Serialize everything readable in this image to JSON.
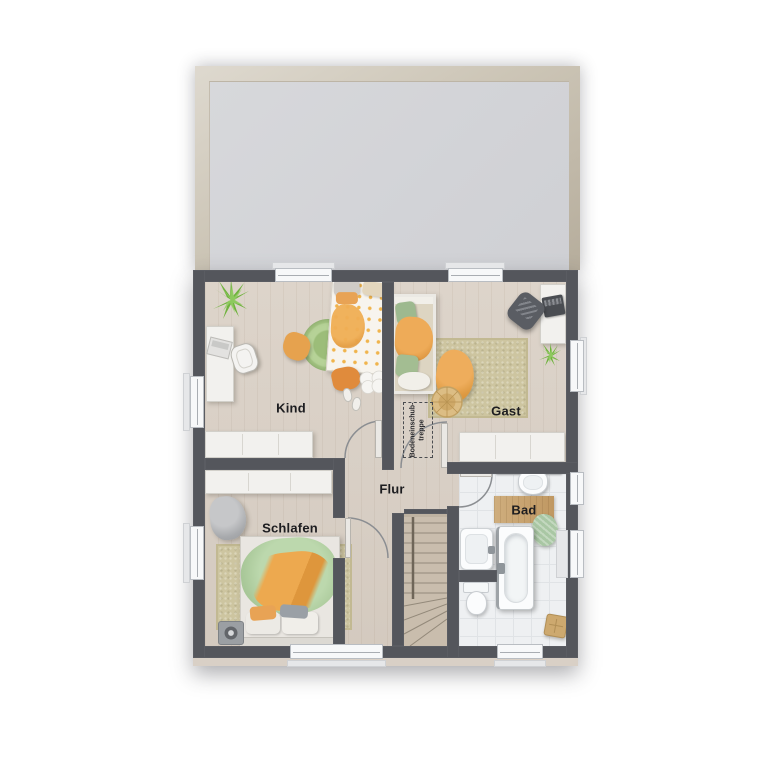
{
  "floorplan": {
    "rooms": [
      {
        "id": "kind",
        "label": "Kind"
      },
      {
        "id": "gast",
        "label": "Gast"
      },
      {
        "id": "flur",
        "label": "Flur"
      },
      {
        "id": "schlafen",
        "label": "Schlafen"
      },
      {
        "id": "bad",
        "label": "Bad"
      }
    ],
    "annotations": {
      "attic_stairs": {
        "line1": "Bodeneinschub-",
        "line2": "treppe"
      }
    },
    "colors": {
      "wall": "#54565c",
      "wood_floor": "#d9d0c6",
      "roof_area": "#d2d3d7",
      "roof_frame": "#c4bcae",
      "bath_tile": "#eef0f2",
      "rug_beige": "#cdc5a0",
      "rug_green": "#a9c789",
      "accent_orange": "#e8a355",
      "accent_green": "#aecf97",
      "stair_wood": "#c9bdad",
      "furniture_white": "#f2f1ee"
    }
  }
}
